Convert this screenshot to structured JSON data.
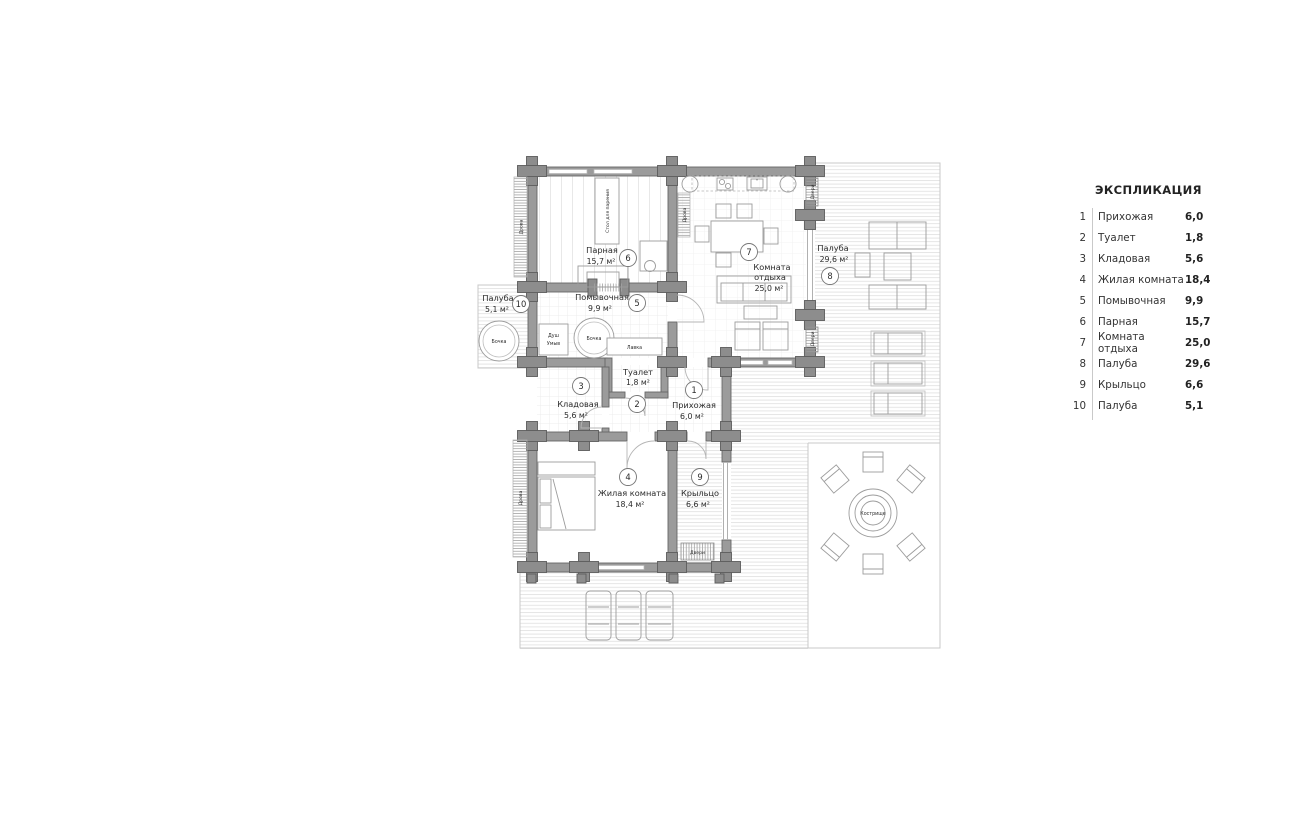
{
  "legend": {
    "title": "ЭКСПЛИКАЦИЯ",
    "rows": [
      {
        "num": "1",
        "name": "Прихожая",
        "area": "6,0"
      },
      {
        "num": "2",
        "name": "Туалет",
        "area": "1,8"
      },
      {
        "num": "3",
        "name": "Кладовая",
        "area": "5,6"
      },
      {
        "num": "4",
        "name": "Жилая комната",
        "area": "18,4"
      },
      {
        "num": "5",
        "name": "Помывочная",
        "area": "9,9"
      },
      {
        "num": "6",
        "name": "Парная",
        "area": "15,7"
      },
      {
        "num": "7",
        "name": "Комната отдыха",
        "area": "25,0"
      },
      {
        "num": "8",
        "name": "Палуба",
        "area": "29,6"
      },
      {
        "num": "9",
        "name": "Крыльцо",
        "area": "6,6"
      },
      {
        "num": "10",
        "name": "Палуба",
        "area": "5,1"
      }
    ]
  },
  "plan": {
    "rooms": {
      "hallway": {
        "num": "1",
        "name": "Прихожая",
        "area": "6,0 м²"
      },
      "toilet": {
        "num": "2",
        "name": "Туалет",
        "area": "1,8 м²"
      },
      "storage": {
        "num": "3",
        "name": "Кладовая",
        "area": "5,6 м²"
      },
      "living": {
        "num": "4",
        "name": "Жилая комната",
        "area": "18,4 м²"
      },
      "washroom": {
        "num": "5",
        "name": "Помывочная",
        "area": "9,9 м²"
      },
      "sauna": {
        "num": "6",
        "name": "Парная",
        "area": "15,7 м²"
      },
      "lounge": {
        "num": "7",
        "name1": "Комната",
        "name2": "отдыха",
        "area": "25,0 м²"
      },
      "deck_main": {
        "num": "8",
        "name": "Палуба",
        "area": "29,6 м²"
      },
      "porch": {
        "num": "9",
        "name": "Крыльцо",
        "area": "6,6 м²"
      },
      "deck_small": {
        "num": "10",
        "name": "Палуба",
        "area": "5,1 м²"
      }
    },
    "fixtures": {
      "barrel": "Бочка",
      "shower1": "Душ",
      "shower2": "Умыв",
      "bench": "Лавка",
      "steam_table": "Стол для парения",
      "firepit": "Кострище",
      "firewood": "Дрова",
      "doors": "Двери"
    }
  },
  "colors": {
    "wall": "#9b9b9b",
    "wall_dark": "#8d8d8d",
    "text": "#2b2b2b",
    "deck_line": "#e2e2e2"
  }
}
